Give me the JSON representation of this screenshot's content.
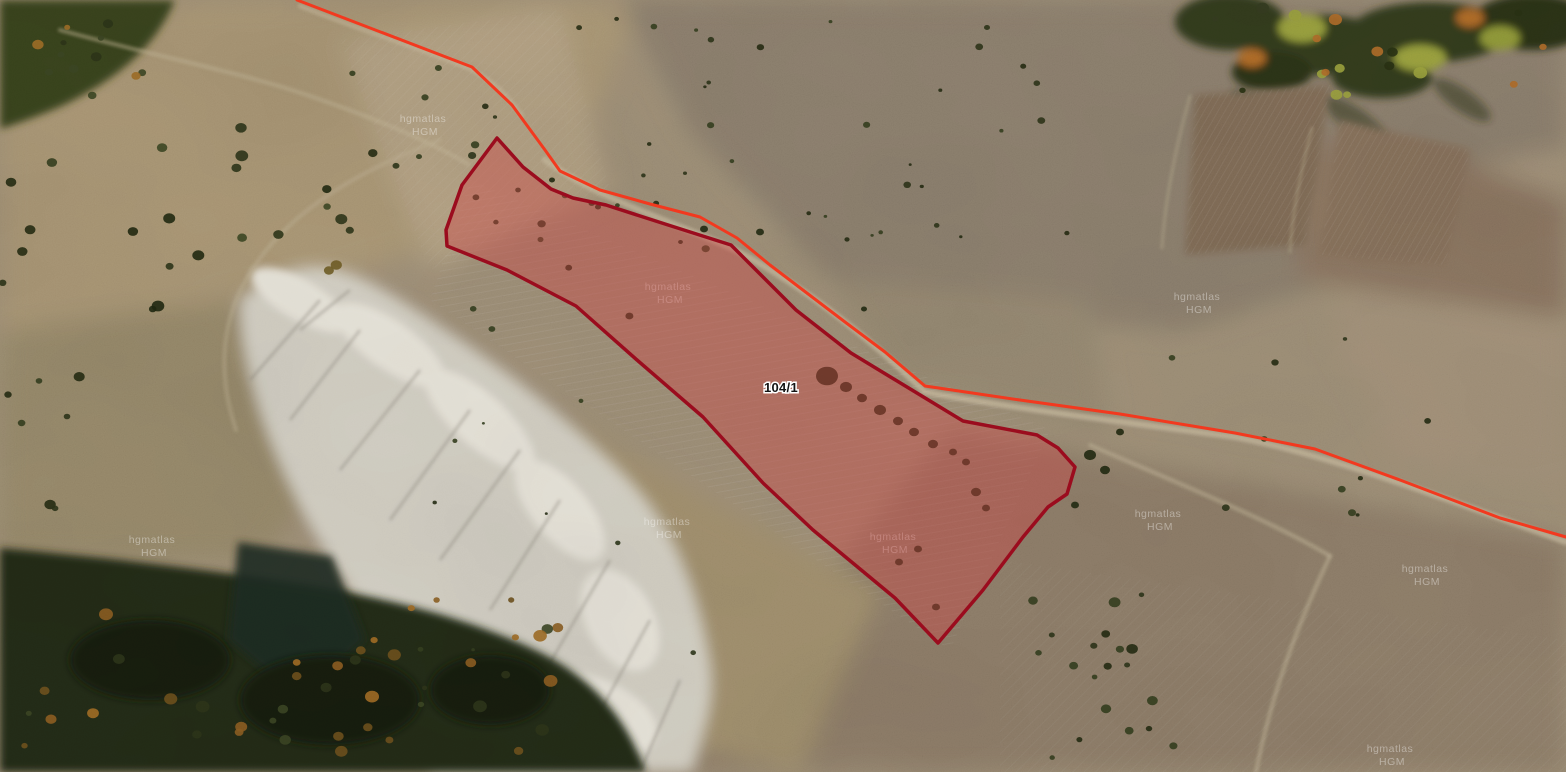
{
  "app": {
    "name": "satellite-parcel-map"
  },
  "map": {
    "imagery_type": "satellite",
    "parcel": {
      "label": "104/1",
      "label_x": 781,
      "label_y": 392,
      "fill_color": "#cc4444",
      "fill_opacity": 0.42,
      "border_color": "#9b0c1e",
      "border_width": 3.5,
      "points": "497,138 523,167 551,189 573,198 606,205 665,224 731,245 796,310 851,353 963,421 1037,435 1058,448 1075,467 1067,494 1048,507 1023,537 983,590 938,643 895,598 813,530 763,483 703,417 637,360 576,306 507,270 447,246 446,230 462,185"
    },
    "route_line": {
      "color": "#f2391f",
      "width": 3,
      "points": "297,0 472,67 512,105 545,150 560,171 600,190 650,204 700,217 737,238 770,265 845,322 885,352 925,386 1020,400 1120,414 1235,433 1315,449 1400,480 1500,518 1566,537"
    },
    "watermark": {
      "line1": "hgmatlas",
      "line2": "HGM",
      "color": "#ffffff",
      "opacity": 0.38,
      "positions": [
        [
          423,
          122
        ],
        [
          668,
          290
        ],
        [
          1197,
          300
        ],
        [
          152,
          543
        ],
        [
          667,
          525
        ],
        [
          893,
          540
        ],
        [
          1158,
          517
        ],
        [
          1425,
          572
        ],
        [
          1390,
          752
        ]
      ]
    }
  }
}
